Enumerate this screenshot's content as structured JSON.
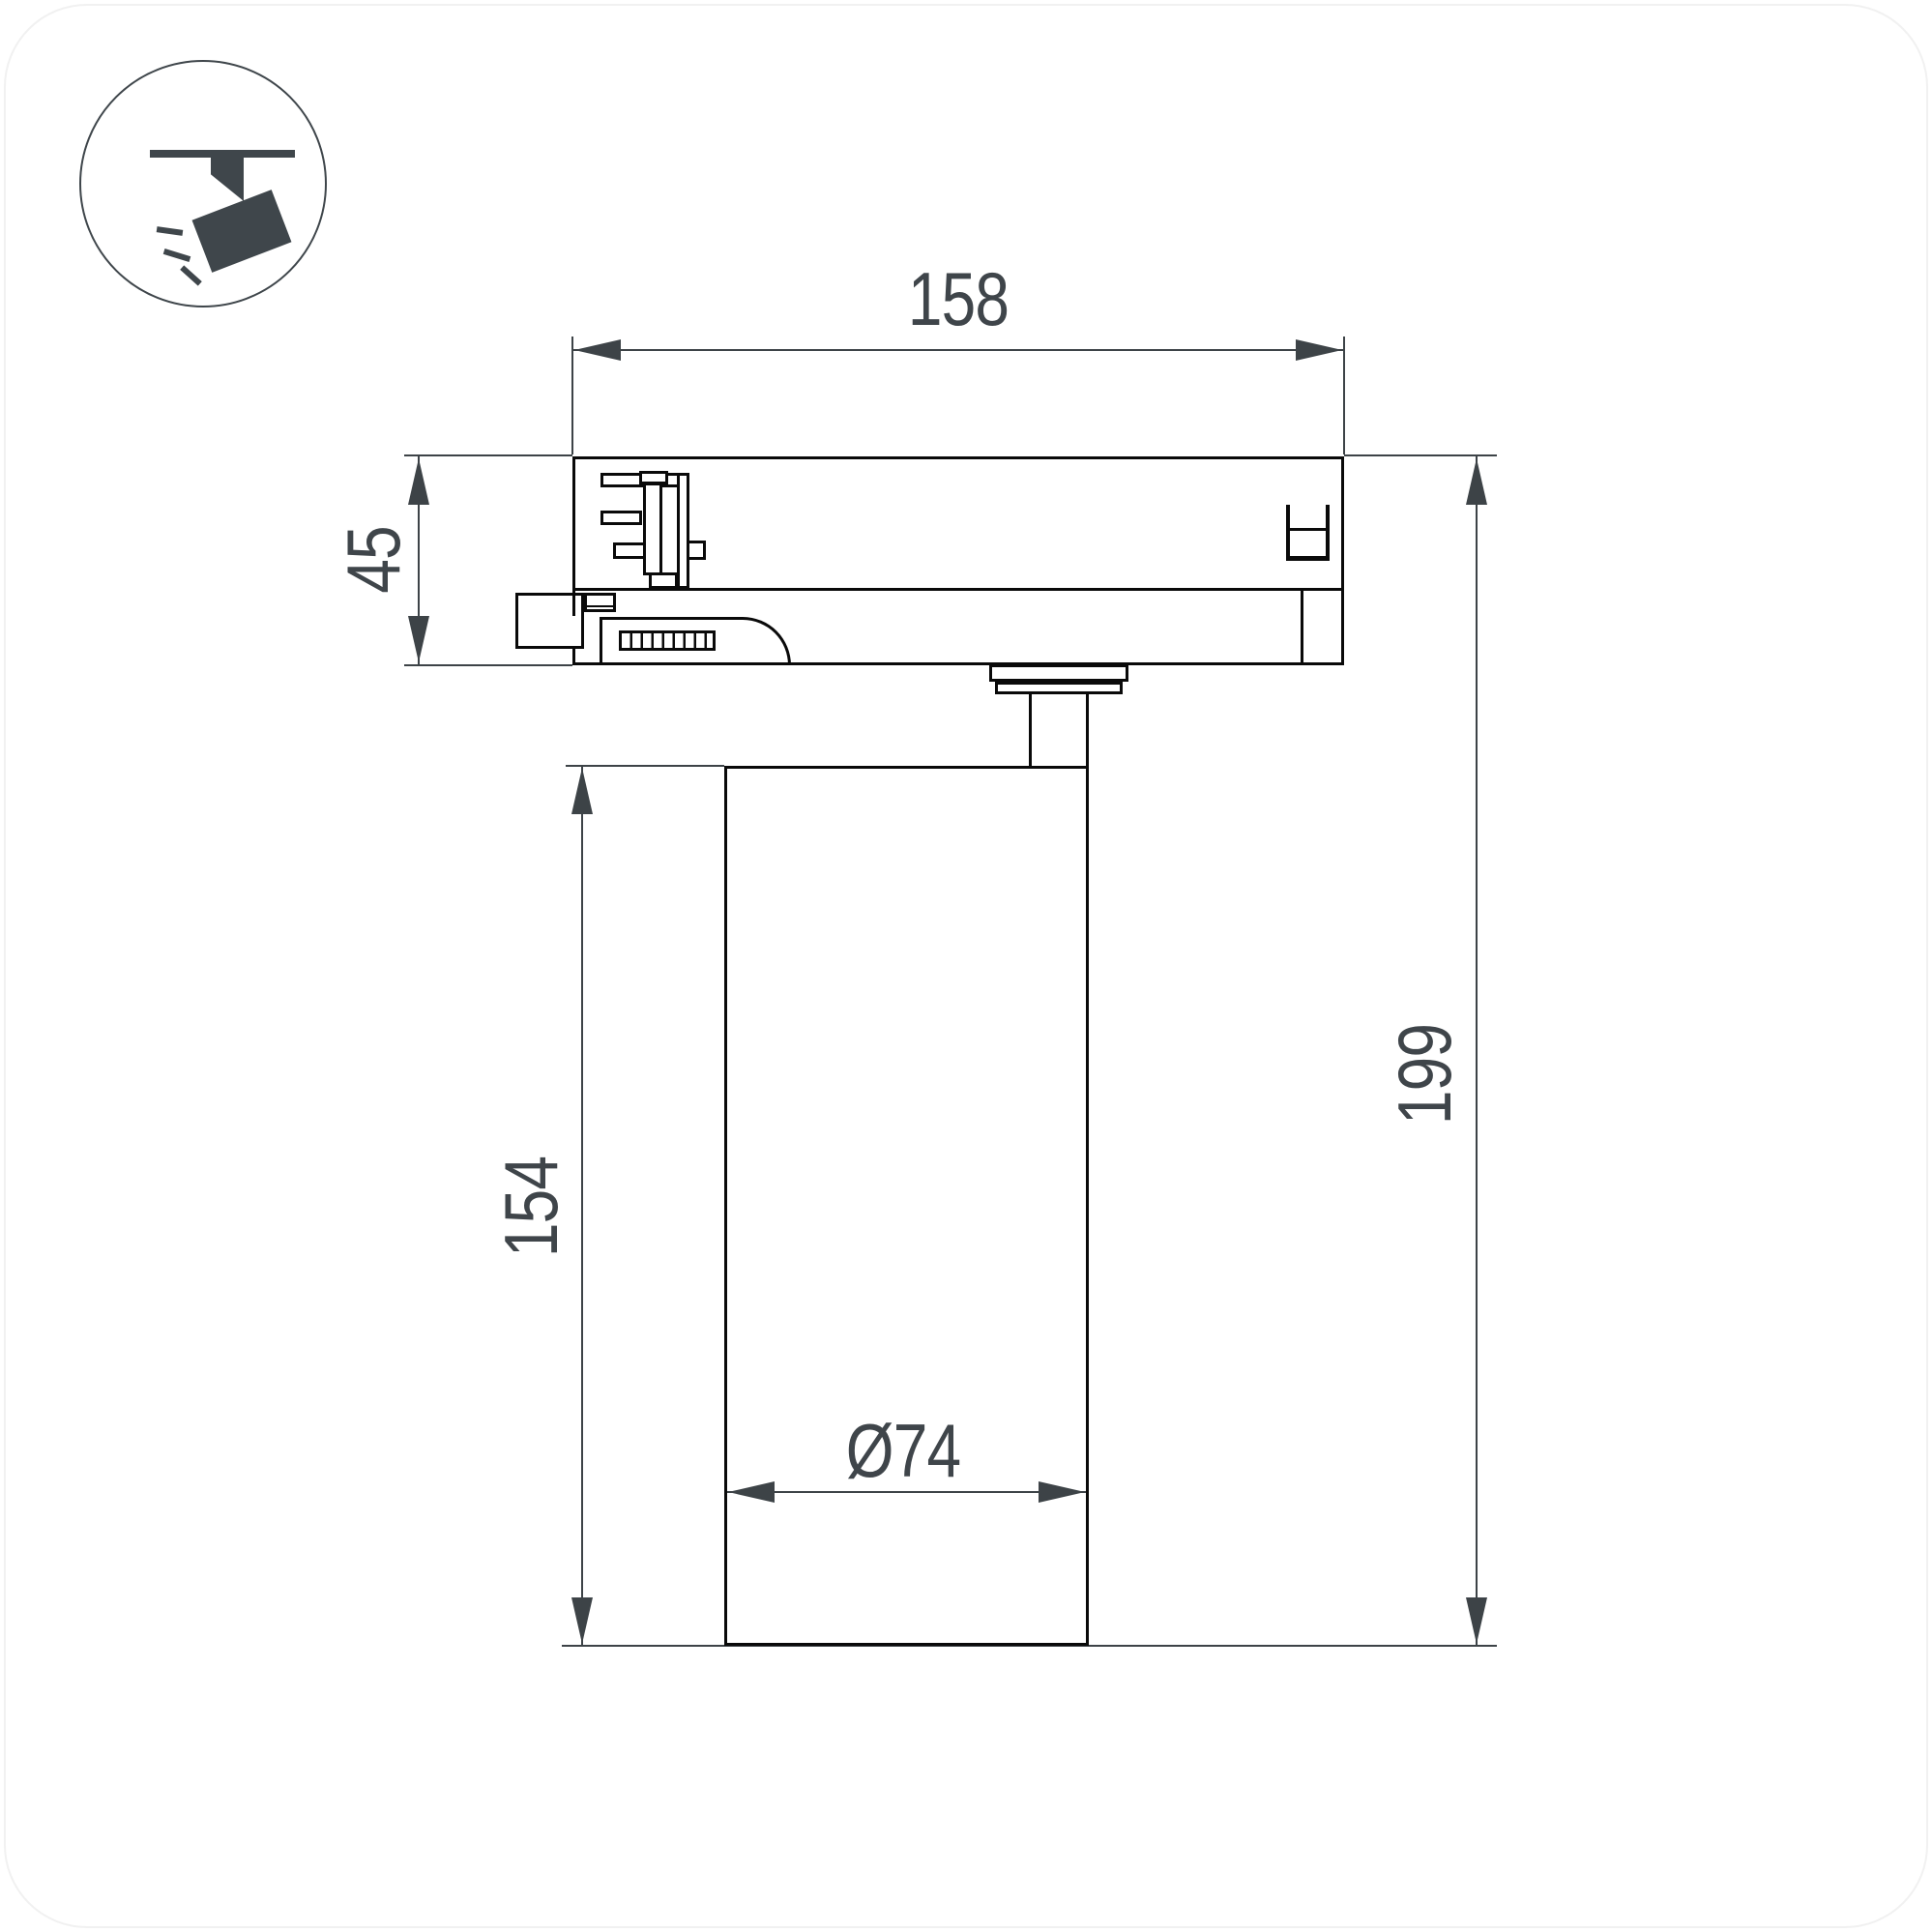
{
  "icon": {
    "name": "track-spotlight-icon"
  },
  "dimensions": {
    "adapter_width": "158",
    "adapter_height": "45",
    "total_height": "199",
    "body_height": "154",
    "body_diameter": "Ø74"
  },
  "colors": {
    "line": "#0a0a0a",
    "dim": "#3d4347",
    "txt": "#3f454a",
    "icon": "#3f464b",
    "bg": "#ffffff"
  }
}
